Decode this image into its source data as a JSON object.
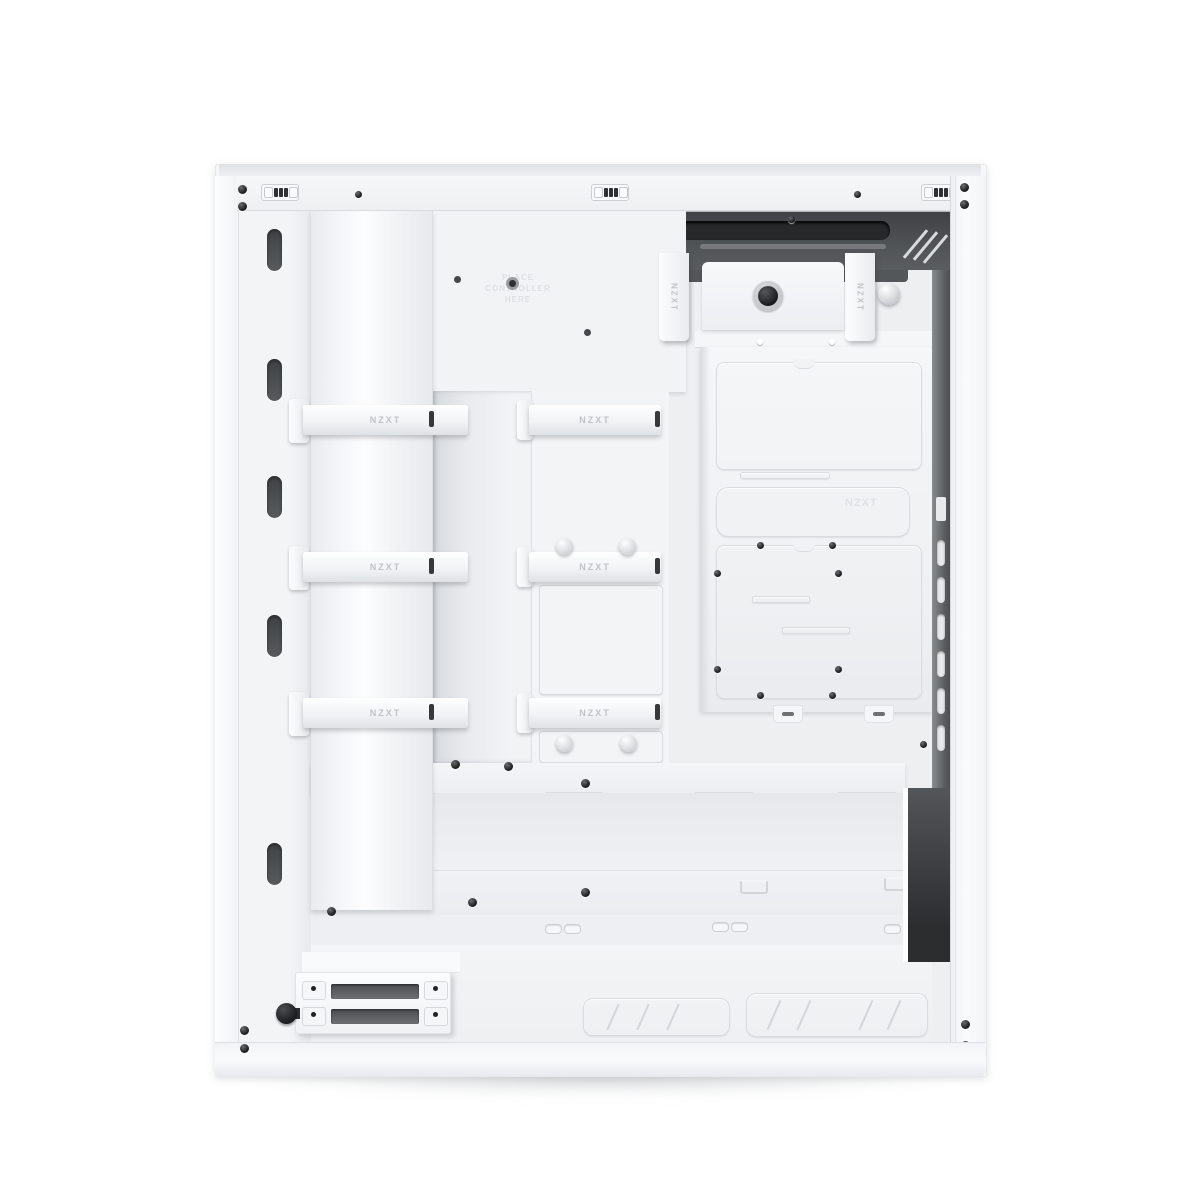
{
  "product": {
    "brand": "NZXT",
    "subject": "White mid-tower PC case, side panel removed, cable-management side interior view"
  },
  "labels": {
    "strap_text": "NZXT",
    "panel_emboss_text": "NZXT",
    "controller_emboss_line1": "PLACE",
    "controller_emboss_line2": "CONTROLLER",
    "controller_emboss_line3": "HERE"
  },
  "colors": {
    "background": "#ffffff",
    "case_white": "#f6f7f9",
    "panel_light": "#f2f3f5",
    "panel_shade": "#e8eaed",
    "recess_dark": "#47494c",
    "slot_black": "#27292b",
    "metal_edge": "#d8dbde",
    "emboss_gray": "#dde0e3",
    "strap_text_gray": "#bfc3c7"
  },
  "counts": {
    "horizontal_cable_straps": 6,
    "hanging_cable_straps": 2,
    "front_frame_cutouts": 5,
    "top_vent_groups": 3,
    "rear_vent_slots": 6,
    "drive_cage_slots": 2
  }
}
